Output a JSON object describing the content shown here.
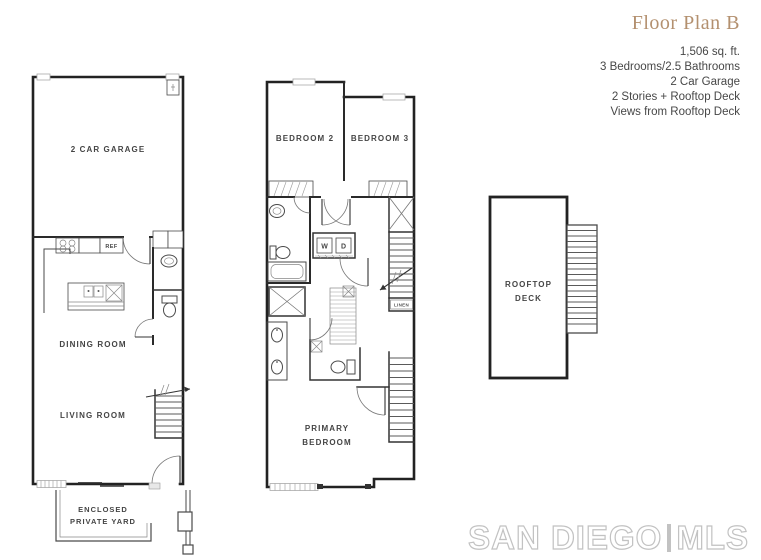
{
  "header": {
    "title": "Floor Plan B",
    "details": [
      "1,506 sq. ft.",
      "3 Bedrooms/2.5 Bathrooms",
      "2 Car Garage",
      "2 Stories + Rooftop Deck",
      "Views from Rooftop Deck"
    ]
  },
  "floor1": {
    "garage_label": "2 CAR GARAGE",
    "ref_label": "REF",
    "dining_label": "DINING ROOM",
    "living_label": "LIVING ROOM",
    "yard_label_line1": "ENCLOSED",
    "yard_label_line2": "PRIVATE YARD"
  },
  "floor2": {
    "bedroom2_label": "BEDROOM 2",
    "bedroom3_label": "BEDROOM 3",
    "washer_label": "W",
    "dryer_label": "D",
    "linen_label": "LINEN",
    "primary_label_line1": "PRIMARY",
    "primary_label_line2": "BEDROOM"
  },
  "rooftop": {
    "deck_label_line1": "ROOFTOP",
    "deck_label_line2": "DECK"
  },
  "logo": {
    "brand": "SAN DIEGO",
    "suffix": "MLS"
  },
  "colors": {
    "title_accent": "#b3906f",
    "detail_text": "#474747",
    "wall": "#222222",
    "label_text": "#454545",
    "logo_gray": "#c2c2c2"
  }
}
